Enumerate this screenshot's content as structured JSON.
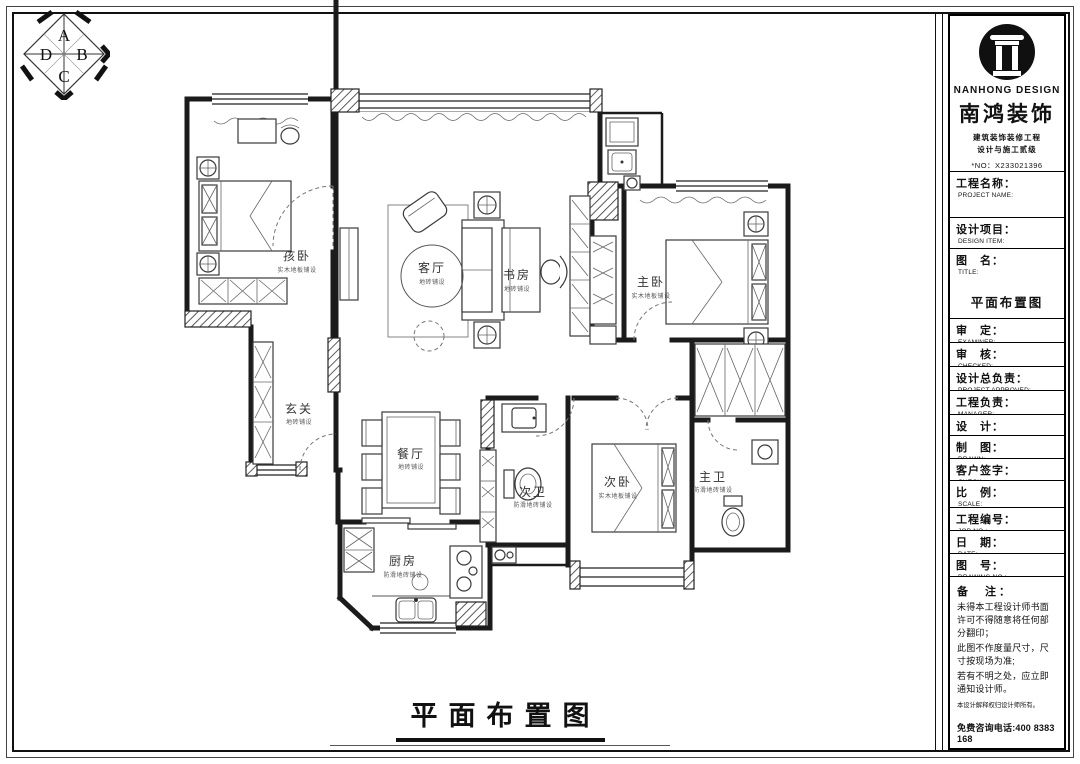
{
  "sheet": {
    "caption": "平面布置图",
    "compass": {
      "top": "A",
      "right": "B",
      "bottom": "C",
      "left": "D"
    }
  },
  "plan": {
    "rooms": [
      {
        "label": "孩卧",
        "note": "实木地板铺设"
      },
      {
        "label": "客厅",
        "note": "地砖铺设"
      },
      {
        "label": "书房",
        "note": "地砖铺设"
      },
      {
        "label": "主卧",
        "note": "实木地板铺设"
      },
      {
        "label": "玄关",
        "note": "地砖铺设"
      },
      {
        "label": "餐厅",
        "note": "地砖铺设"
      },
      {
        "label": "次卫",
        "note": "防滑地砖铺设"
      },
      {
        "label": "次卧",
        "note": "实木地板铺设"
      },
      {
        "label": "主卫",
        "note": "防滑地砖铺设"
      },
      {
        "label": "厨房",
        "note": "防滑地砖铺设"
      }
    ]
  },
  "titleblock": {
    "logo_icon": "roman-column-icon",
    "brand_en": "NANHONG DESIGN",
    "brand_cn": "南鸿装饰",
    "brand_sub1": "建筑装饰装修工程",
    "brand_sub2": "设计与施工贰级",
    "brand_no": "*NO：X233021396",
    "fields": [
      {
        "cn": "工程名称：",
        "en": "PROJECT NAME:",
        "value": ""
      },
      {
        "cn": "设计项目：",
        "en": "DESIGN ITEM:",
        "value": ""
      },
      {
        "cn": "图　名：",
        "en": "TITLE:",
        "value": "平面布置图"
      },
      {
        "cn": "审　定：",
        "en": "EXAMINER:",
        "value": ""
      },
      {
        "cn": "审　核：",
        "en": "CHECKED:",
        "value": ""
      },
      {
        "cn": "设计总负责：",
        "en": "PROJECT APPROVED:",
        "value": ""
      },
      {
        "cn": "工程负责：",
        "en": "MANAGER:",
        "value": ""
      },
      {
        "cn": "设　计：",
        "en": "DESIGNER:",
        "value": ""
      },
      {
        "cn": "制　图：",
        "en": "DRAWN:",
        "value": ""
      },
      {
        "cn": "客户签字：",
        "en": "CHECK:",
        "value": ""
      },
      {
        "cn": "比　例：",
        "en": "SCALE:",
        "value": ""
      },
      {
        "cn": "工程编号：",
        "en": "JOB NO.:",
        "value": ""
      },
      {
        "cn": "日　期：",
        "en": "DATE:",
        "value": ""
      },
      {
        "cn": "图　号：",
        "en": "DRAWING NO.:",
        "value": ""
      }
    ],
    "notes": {
      "title": "备　注：",
      "line1": "未得本工程设计师书面许可不得随意将任何部分翻印；",
      "line2": "此图不作度量尺寸，尺寸按现场为准;",
      "line3": "若有不明之处，应立即通知设计师。",
      "small": "本设计解释权归设计师所有。",
      "hotline": "免费咨询电话:400 8383 168"
    }
  }
}
